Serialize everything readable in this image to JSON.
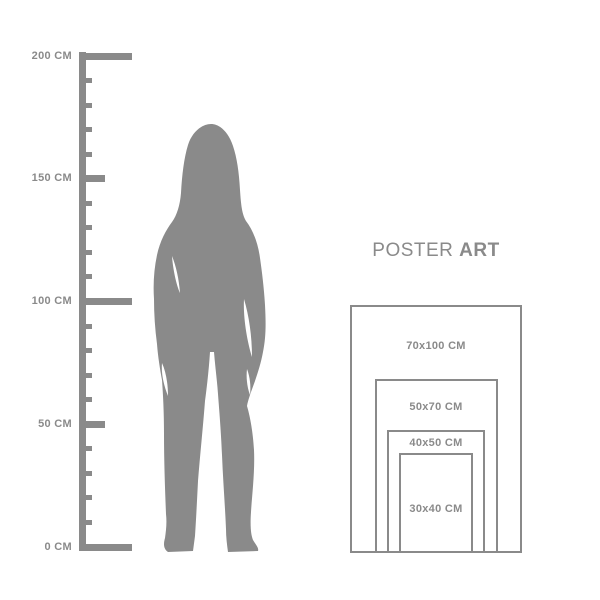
{
  "colors": {
    "background": "#ffffff",
    "gray": "#8a8a8a"
  },
  "ruler": {
    "unit": "CM",
    "max_value": 200,
    "min_value": 0,
    "minor_step": 10,
    "labels": [
      {
        "text": "200 CM",
        "value": 200
      },
      {
        "text": "150 CM",
        "value": 150
      },
      {
        "text": "100 CM",
        "value": 100
      },
      {
        "text": "50 CM",
        "value": 50
      },
      {
        "text": "0 CM",
        "value": 0
      }
    ]
  },
  "figure": {
    "alt": "woman-silhouette"
  },
  "poster": {
    "title_regular": "POSTER",
    "title_bold": "ART",
    "sizes": [
      {
        "label": "70x100 CM",
        "width_cm": 70,
        "height_cm": 100
      },
      {
        "label": "50x70 CM",
        "width_cm": 50,
        "height_cm": 70
      },
      {
        "label": "40x50 CM",
        "width_cm": 40,
        "height_cm": 50
      },
      {
        "label": "30x40 CM",
        "width_cm": 30,
        "height_cm": 40
      }
    ]
  }
}
